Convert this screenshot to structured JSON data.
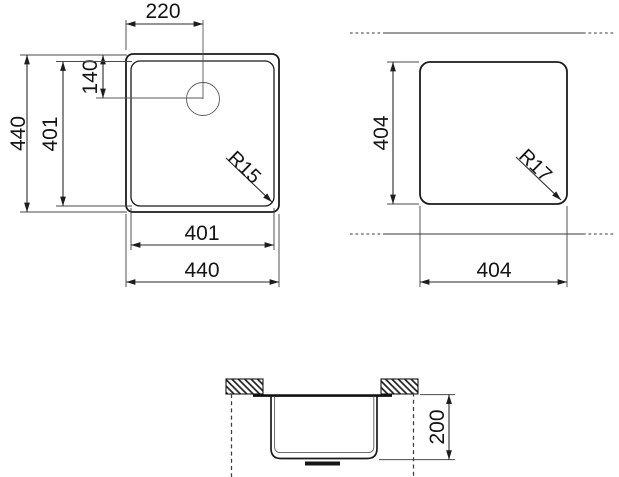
{
  "drawing": {
    "description": "Sink technical dimension drawing, three views",
    "colors": {
      "ink": "#1b1b1b",
      "centerline": "#7a7a7a",
      "background": "#ffffff"
    },
    "front_view": {
      "tap_hole_offset_x": "220",
      "tap_hole_offset_y": "140",
      "bowl_height": "401",
      "overall_height": "440",
      "bowl_width": "401",
      "overall_width": "440",
      "bowl_corner_radius": "R15"
    },
    "cutout_view": {
      "cutout_height": "404",
      "cutout_width": "404",
      "cutout_corner_radius": "R17"
    },
    "section_view": {
      "bowl_depth": "200"
    }
  }
}
